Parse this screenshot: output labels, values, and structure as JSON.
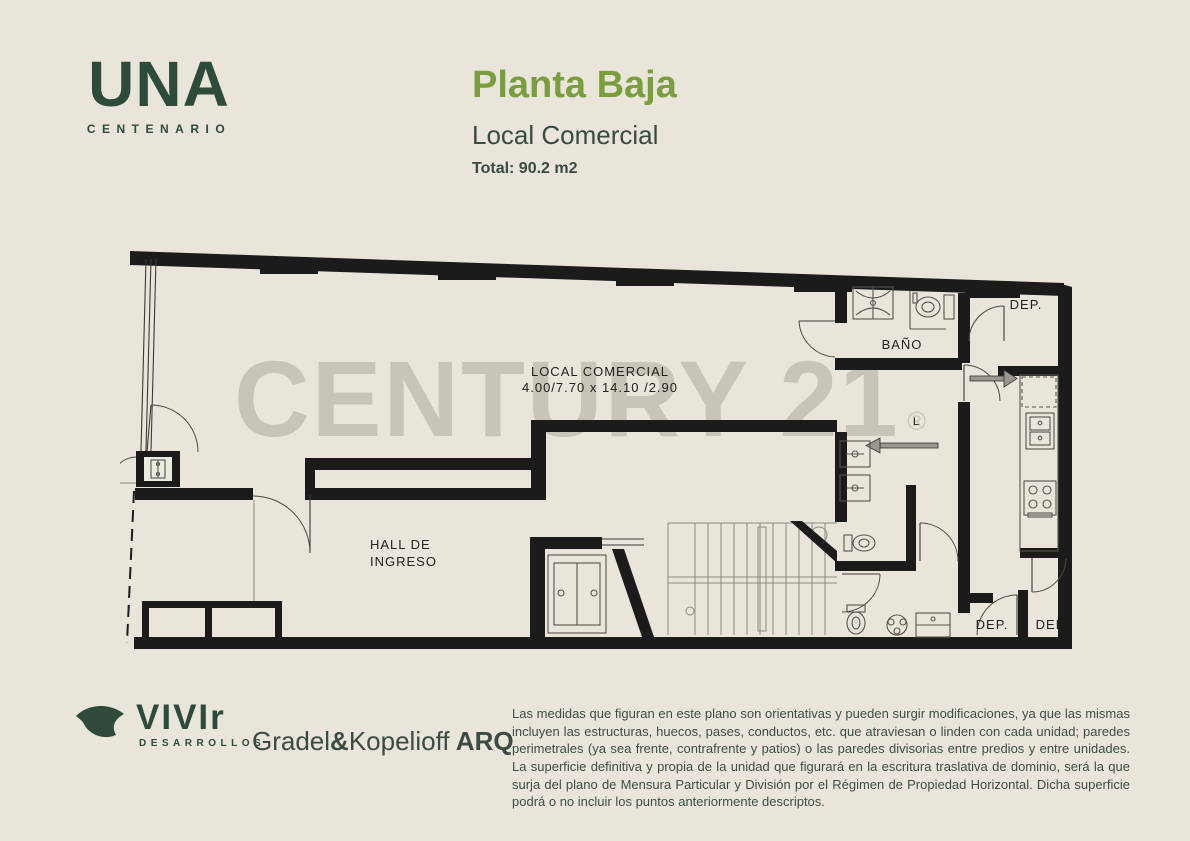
{
  "colors": {
    "background": "#e9e5da",
    "brand_green": "#2d4a3b",
    "title_green": "#7a9e3d",
    "text_dark": "#394a40",
    "wall_black": "#1b1b1b",
    "watermark_gray": "#c8c4b7"
  },
  "header": {
    "logo": {
      "text": "UNA",
      "subtext": "CENTENARIO"
    },
    "title": "Planta Baja",
    "subtitle": "Local Comercial",
    "total": "Total: 90.2 m2"
  },
  "plan": {
    "watermark": "CENTURY 21",
    "watermark_reg": "®",
    "labels": {
      "local_line1": "LOCAL  COMERCIAL",
      "local_line2": "4.00/7.70  x  14.10  /2.90",
      "hall_line1": "HALL  DE",
      "hall_line2": "INGRESO",
      "bano": "BAÑO",
      "dep_top": "DEP.",
      "dep_bottom_left": "DEP.",
      "dep_bottom_right": "DEP.",
      "l_small": "L"
    }
  },
  "footer": {
    "vivir": {
      "text": "VIVIr",
      "subtext": "DESARROLLOS"
    },
    "arq": {
      "p1": "Gradel",
      "amp": "&",
      "p2": "Kopelioff",
      "p3": " ARQ"
    },
    "disclaimer": "Las medidas que figuran en este plano son orientativas y pueden surgir modificaciones, ya que las mismas incluyen las estructuras, huecos, pases, conductos, etc. que atraviesan o linden con cada unidad; paredes perimetrales (ya sea frente, contrafrente y patios) o las paredes divisorias entre predios y entre unidades. La superficie definitiva y propia de la unidad que figurará en la escritura traslativa de dominio, será la que surja del plano de Mensura Particular y División por el Régimen de Propiedad Horizontal. Dicha superficie podrá o no incluir los puntos anteriormente descriptos."
  }
}
